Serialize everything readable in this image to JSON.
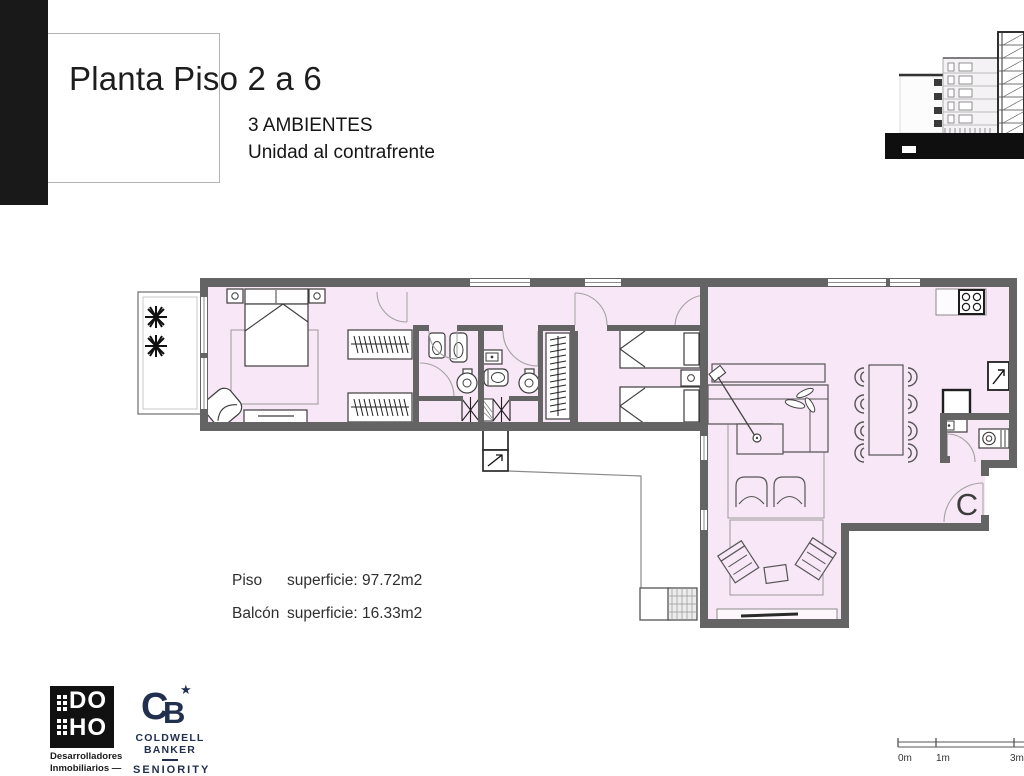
{
  "header": {
    "title": "Planta Piso 2 a 6",
    "subtitle1": "3 AMBIENTES",
    "subtitle2": "Unidad al contrafrente"
  },
  "plan": {
    "unit_label": "C",
    "floor_fill": "#f8e7f6",
    "wall_color": "#646464"
  },
  "measurements": {
    "rows": [
      {
        "label": "Piso",
        "value": "superficie: 97.72m2"
      },
      {
        "label": "Balcón",
        "value": "superficie: 16.33m2"
      }
    ]
  },
  "branding": {
    "doho": {
      "line1": "DO",
      "line2": "HO",
      "caption1": "Desarrolladores",
      "caption2": "Inmobiliarios —"
    },
    "coldwell": {
      "mono_c": "C",
      "mono_b": "B",
      "star": "★",
      "line1": "COLDWELL",
      "line2": "BANKER",
      "line3": "SENIORITY"
    }
  },
  "scalebar": {
    "labels": [
      "0m",
      "1m",
      "3m"
    ]
  }
}
